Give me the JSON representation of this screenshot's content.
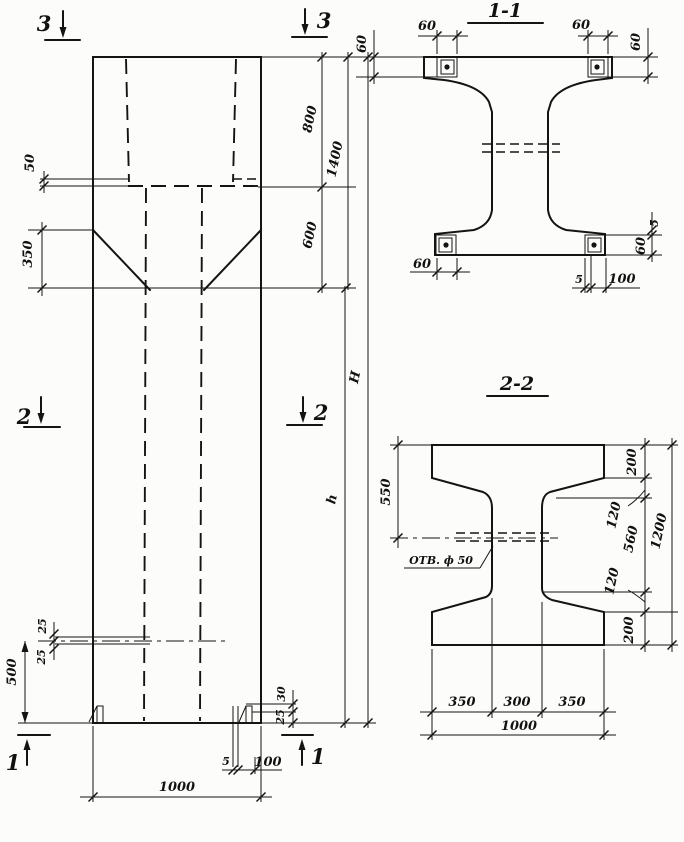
{
  "drawing": {
    "kind": "reinforced-concrete column working drawing",
    "elevation": {
      "section_marks": {
        "s3_left": "3",
        "s3_right": "3",
        "s2_left": "2",
        "s2_right": "2",
        "s1_left": "1",
        "s1_right": "1"
      },
      "dims": {
        "ledge_offset": "50",
        "taper_height": "350",
        "head_length": "800",
        "head_total": "1400",
        "transition_length": "600",
        "shaft_length": "h",
        "total_height": "Н",
        "hole_top": "25",
        "hole_bottom": "25",
        "hole_from_bottom": "500",
        "lug_top": "30",
        "lug_bottom": "25",
        "anchor_thickness": "5",
        "anchor_length": "100",
        "column_width": "1000"
      }
    },
    "section_1_1": {
      "title": "1-1",
      "dims": {
        "plate_top_left_w": "60",
        "plate_top_right_w": "60",
        "plate_left_h": "60",
        "plate_right_h": "60",
        "plate_bottom_left_w": "60",
        "bottom_gap": "5",
        "plate_bottom_w": "100",
        "side_gap": "5",
        "plate_bottom_right_h": "60"
      }
    },
    "section_2_2": {
      "title": "2-2",
      "hole_label": "ОТВ. ф 50",
      "dims": {
        "top_to_hole": "550",
        "flange_top": "200",
        "fillet_top": "120",
        "web_height": "560",
        "fillet_bottom": "120",
        "flange_bottom": "200",
        "section_height": "1200",
        "flange_left": "350",
        "web_width": "300",
        "flange_right": "350",
        "section_width": "1000"
      }
    }
  }
}
